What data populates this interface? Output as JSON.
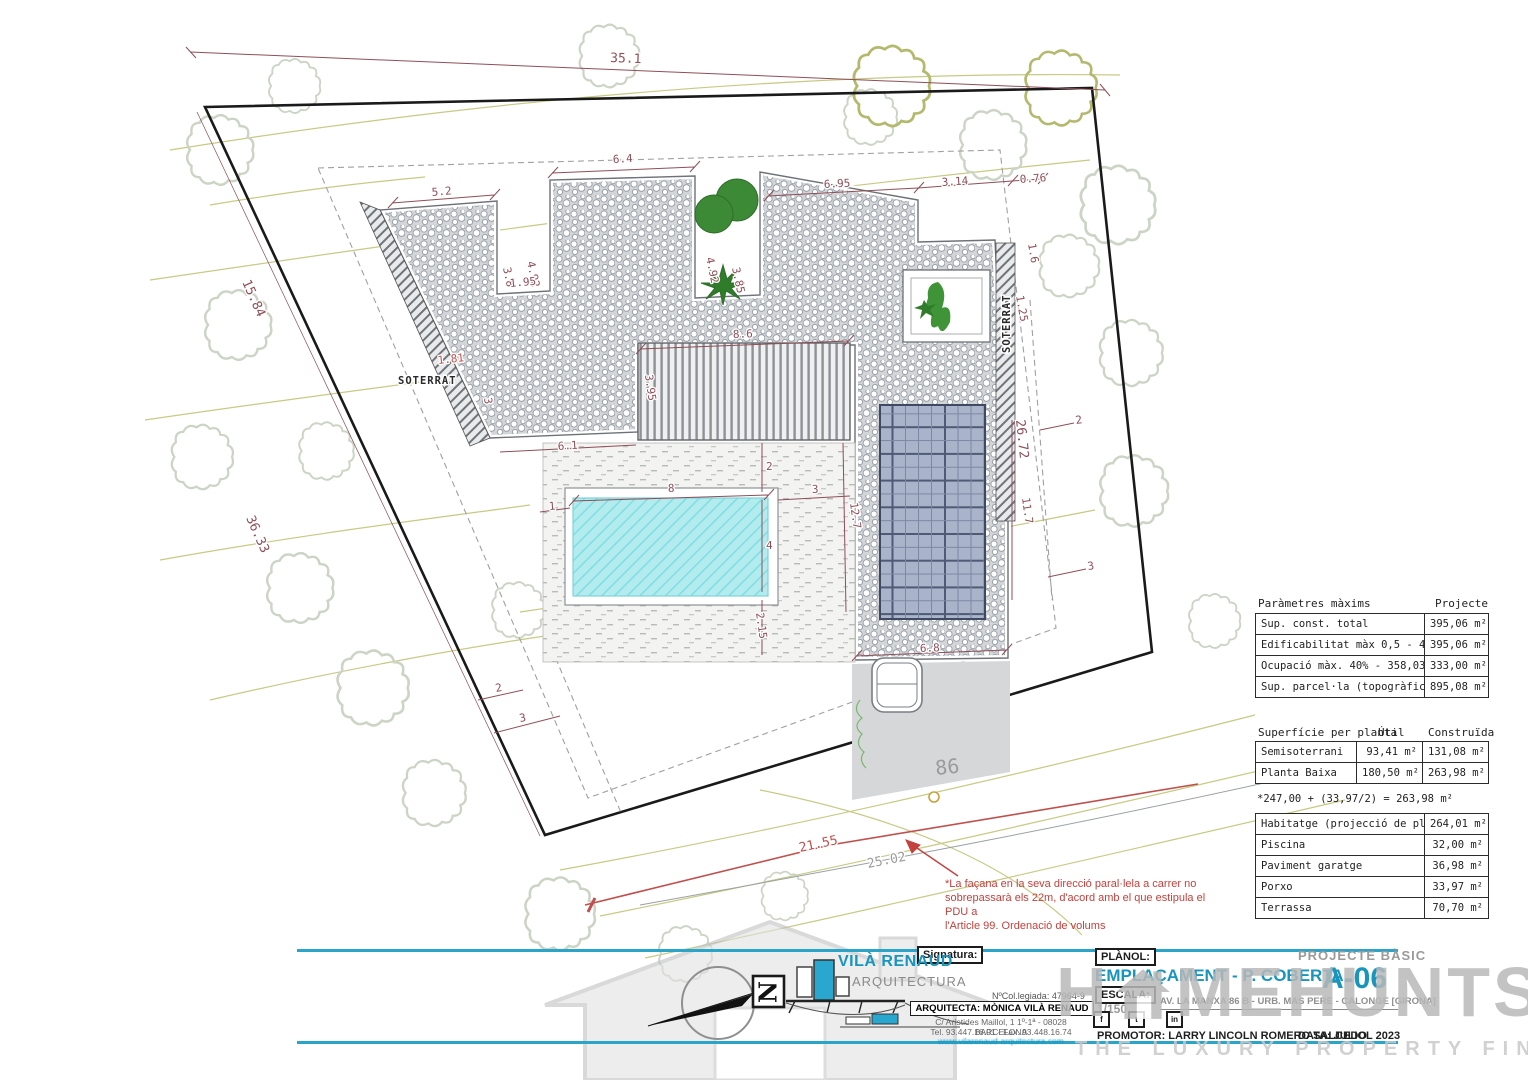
{
  "plan": {
    "dims": [
      "35.1",
      "15.84",
      "36.33",
      "26.72",
      "21.55",
      "25.02",
      "5.2",
      "6.4",
      "4.92",
      "3.8",
      "1.95",
      "4.92",
      "3.85",
      "6.95",
      "3.14",
      "0.76",
      "1.6",
      "1.25",
      "8.6",
      "3.95",
      "6.1",
      "2",
      "8",
      "1",
      "3",
      "12.7",
      "4",
      "2.15",
      "11.7",
      "6.8",
      "2",
      "3",
      "2",
      "3",
      "1.81",
      "3",
      "86",
      "SOTERRAT",
      "SOTERRAT"
    ],
    "note": {
      "line1": "*La façana en la seva direcció paral·lela a carrer no",
      "line2": "sobrepassarà els 22m, d'acord amb el que estipula el PDU  a",
      "line3": "l'Article 99. Ordenació de volums"
    },
    "compass_letter": "N"
  },
  "tables": {
    "maxims": {
      "title": "Paràmetres màxims",
      "col": "Projecte",
      "rows": [
        [
          "Sup. const. total",
          "395,06 m²"
        ],
        [
          "Edificabilitat màx 0,5 - 447,54 m²",
          "395,06 m²"
        ],
        [
          "Ocupació màx. 40% - 358,03 m²",
          "333,00 m²"
        ],
        [
          "Sup. parcel·la (topogràfic)",
          "895,08 m²"
        ]
      ]
    },
    "per_planta": {
      "title": "Superfície per planta",
      "col1": "Útil",
      "col2": "Construïda",
      "rows": [
        [
          "Semisoterrani",
          "93,41 m²",
          "131,08 m²"
        ],
        [
          "Planta Baixa",
          "180,50 m²",
          "263,98 m²"
        ]
      ],
      "note": "*247,00 + (33,97/2) = 263,98 m²"
    },
    "superficies": {
      "rows": [
        [
          "Habitatge (projecció de plantes)",
          "264,01 m²"
        ],
        [
          "Piscina",
          "32,00 m²"
        ],
        [
          "Paviment garatge",
          "36,98 m²"
        ],
        [
          "Porxo",
          "33,97 m²"
        ],
        [
          "Terrassa",
          "70,70 m²"
        ]
      ]
    }
  },
  "title_block": {
    "signatura_label": "Signatura:",
    "logo_name": "VILÀ RENAUD",
    "logo_sub": "ARQUITECTURA",
    "col_number": "NºCol.legiada: 47964-9",
    "arquitecta": "ARQUITECTA: MÒNICA VILÀ RENAUD",
    "address": "C/ Arístides Maillol, 1 1º-1ª - 08028 BARCELONA",
    "phone": "Tel. 93.447.16.01 - Fax. 93.448.16.74",
    "web": "www.vilarenaud-arquitectura.com",
    "planol_label": "PLÀNOL:",
    "planol_value": "EMPLAÇAMENT - P. COBERTA",
    "escala_label": "ESCALA:",
    "escala_value": "1/150",
    "project_type": "PROJECTE BÀSIC",
    "sheet": "A-06",
    "site_address": "AV. LA MANXA 86 B - URB. MAS PERE - CALONGE [GIRONA]",
    "promotor": "PROMOTOR: LARRY LINCOLN ROMERO SALCEDO",
    "data": "DATA: JULIOL 2023",
    "social": [
      "f",
      "t",
      "in"
    ]
  },
  "watermark": {
    "part1": "H",
    "part2": "MEHUNTS",
    "tagline": "THE LUXURY PROPERTY FINDERS"
  },
  "colors": {
    "teal": "#1795bd",
    "logo_cyan": "#2aa7cf",
    "dim_maroon": "#8f4e58",
    "note_red": "#c4413d",
    "road_red": "#c0504d",
    "contour_olive": "#c6ca82",
    "tree_green": "#3c8a36",
    "pool_cyan": "#b2ecef",
    "watermark_gray": "#b9b9b9"
  }
}
